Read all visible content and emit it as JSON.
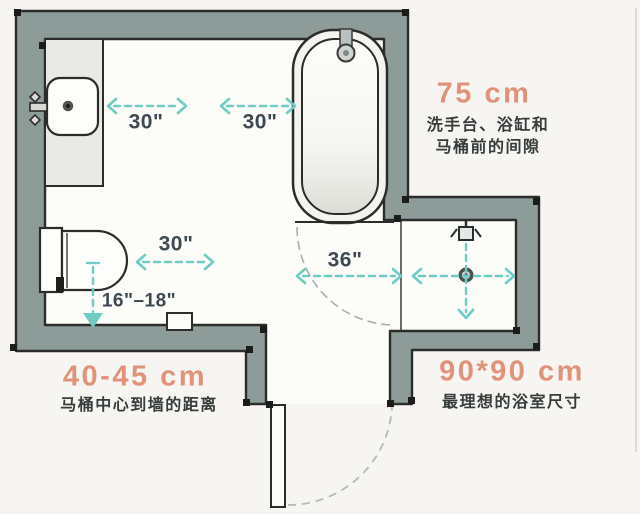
{
  "labels": {
    "sink_clearance": "30\"",
    "tub_clearance": "30\"",
    "toilet_clearance": "30\"",
    "toilet_to_wall": "16\"–18\"",
    "door_width": "36\""
  },
  "annotations": {
    "clearance": {
      "value": "75 cm",
      "line1": "洗手台、浴缸和",
      "line2": "马桶前的间隙"
    },
    "toilet_center": {
      "value": "40-45 cm",
      "label": "马桶中心到墙的距离"
    },
    "shower_size": {
      "value": "90*90 cm",
      "label": "最理想的浴室尺寸"
    }
  },
  "fixtures": [
    "sink",
    "bathtub",
    "toilet",
    "shower-head",
    "floor-drain",
    "door"
  ],
  "colors": {
    "wall": "#8d9c99",
    "outline": "#2c2c2a",
    "floor": "#fcfcf9",
    "counter": "#e9e9e5",
    "arrow_teal": "#6fccc5",
    "accent_orange": "#e0937a",
    "dimension_text": "#3e4952",
    "annotation_text": "#363d3b"
  }
}
